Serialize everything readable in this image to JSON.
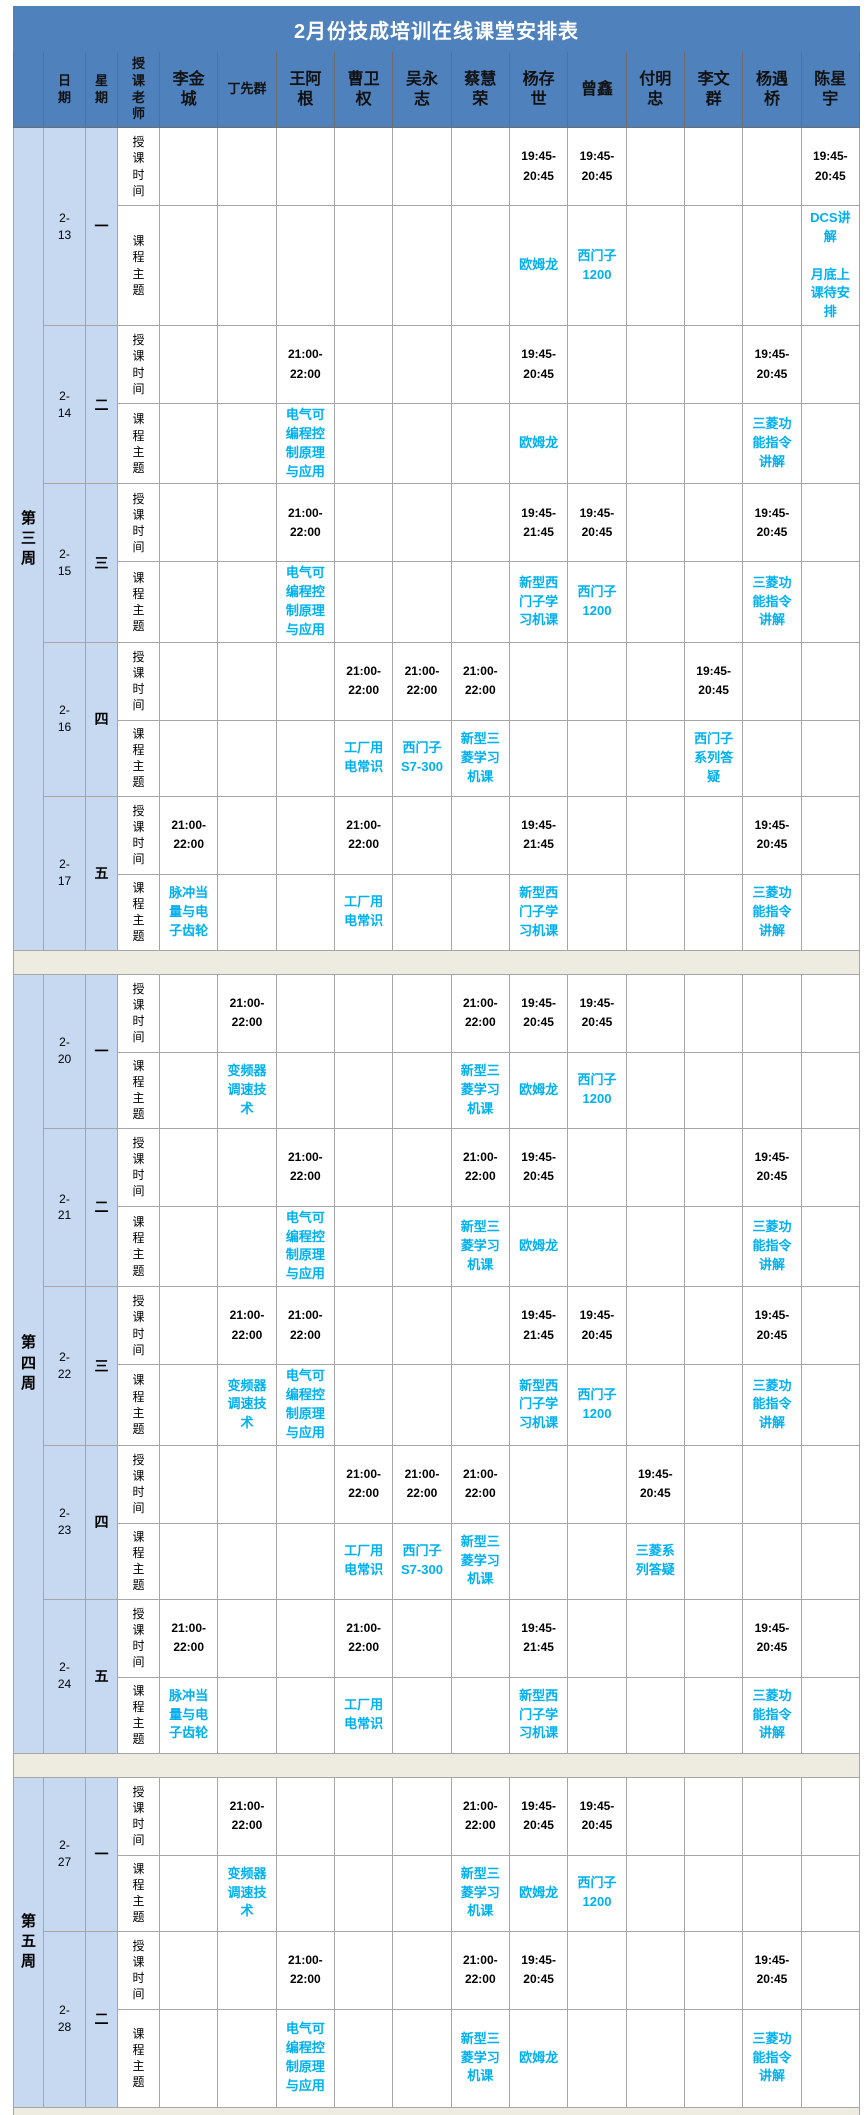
{
  "title": "2月份技成培训在线课堂安排表",
  "header": {
    "date": "日期",
    "weekday": "星期",
    "teacher_label": "授课老师",
    "teachers": [
      "李金城",
      "丁先群",
      "王阿根",
      "曹卫权",
      "吴永志",
      "蔡慧荣",
      "杨存世",
      "曾鑫",
      "付明忠",
      "李文群",
      "杨遇桥",
      "陈星宇"
    ]
  },
  "row_labels": {
    "time": "授课时间",
    "topic": "课程主题"
  },
  "colors": {
    "header_blue": "#4F81BD",
    "light_blue": "#C6D9F1",
    "topic_text": "#00B0F0",
    "separator_beige": "#EEECE1",
    "border_gray": "#A6A6A6",
    "title_text": "#FFFFFF"
  },
  "weeks": [
    {
      "label": "第三周",
      "days": [
        {
          "date": "2-13",
          "weekday": "一",
          "times": [
            "",
            "",
            "",
            "",
            "",
            "",
            "19:45-20:45",
            "19:45-20:45",
            "",
            "",
            "",
            "19:45-20:45"
          ],
          "topics": [
            "",
            "",
            "",
            "",
            "",
            "",
            "欧姆龙",
            "西门子1200",
            "",
            "",
            "",
            "DCS讲解\n\n月底上课待安排"
          ]
        },
        {
          "date": "2-14",
          "weekday": "二",
          "times": [
            "",
            "",
            "21:00-22:00",
            "",
            "",
            "",
            "19:45-20:45",
            "",
            "",
            "",
            "19:45-20:45",
            ""
          ],
          "topics": [
            "",
            "",
            "电气可编程控制原理与应用",
            "",
            "",
            "",
            "欧姆龙",
            "",
            "",
            "",
            "三菱功能指令讲解",
            ""
          ]
        },
        {
          "date": "2-15",
          "weekday": "三",
          "times": [
            "",
            "",
            "21:00-22:00",
            "",
            "",
            "",
            "19:45-21:45",
            "19:45-20:45",
            "",
            "",
            "19:45-20:45",
            ""
          ],
          "topics": [
            "",
            "",
            "电气可编程控制原理与应用",
            "",
            "",
            "",
            "新型西门子学习机课",
            "西门子1200",
            "",
            "",
            "三菱功能指令讲解",
            ""
          ]
        },
        {
          "date": "2-16",
          "weekday": "四",
          "times": [
            "",
            "",
            "",
            "21:00-22:00",
            "21:00-22:00",
            "21:00-22:00",
            "",
            "",
            "",
            "19:45-20:45",
            "",
            ""
          ],
          "topics": [
            "",
            "",
            "",
            "工厂用电常识",
            "西门子S7-300",
            "新型三菱学习机课",
            "",
            "",
            "",
            "西门子系列答疑",
            "",
            ""
          ]
        },
        {
          "date": "2-17",
          "weekday": "五",
          "times": [
            "21:00-22:00",
            "",
            "",
            "21:00-22:00",
            "",
            "",
            "19:45-21:45",
            "",
            "",
            "",
            "19:45-20:45",
            ""
          ],
          "topics": [
            "脉冲当量与电子齿轮",
            "",
            "",
            "工厂用电常识",
            "",
            "",
            "新型西门子学习机课",
            "",
            "",
            "",
            "三菱功能指令讲解",
            ""
          ]
        }
      ]
    },
    {
      "label": "第四周",
      "days": [
        {
          "date": "2-20",
          "weekday": "一",
          "times": [
            "",
            "21:00-22:00",
            "",
            "",
            "",
            "21:00-22:00",
            "19:45-20:45",
            "19:45-20:45",
            "",
            "",
            "",
            ""
          ],
          "topics": [
            "",
            "变频器调速技术",
            "",
            "",
            "",
            "新型三菱学习机课",
            "欧姆龙",
            "西门子1200",
            "",
            "",
            "",
            ""
          ]
        },
        {
          "date": "2-21",
          "weekday": "二",
          "times": [
            "",
            "",
            "21:00-22:00",
            "",
            "",
            "21:00-22:00",
            "19:45-20:45",
            "",
            "",
            "",
            "19:45-20:45",
            ""
          ],
          "topics": [
            "",
            "",
            "电气可编程控制原理与应用",
            "",
            "",
            "新型三菱学习机课",
            "欧姆龙",
            "",
            "",
            "",
            "三菱功能指令讲解",
            ""
          ]
        },
        {
          "date": "2-22",
          "weekday": "三",
          "times": [
            "",
            "21:00-22:00",
            "21:00-22:00",
            "",
            "",
            "",
            "19:45-21:45",
            "19:45-20:45",
            "",
            "",
            "19:45-20:45",
            ""
          ],
          "topics": [
            "",
            "变频器调速技术",
            "电气可编程控制原理与应用",
            "",
            "",
            "",
            "新型西门子学习机课",
            "西门子1200",
            "",
            "",
            "三菱功能指令讲解",
            ""
          ]
        },
        {
          "date": "2-23",
          "weekday": "四",
          "times": [
            "",
            "",
            "",
            "21:00-22:00",
            "21:00-22:00",
            "21:00-22:00",
            "",
            "",
            "19:45-20:45",
            "",
            "",
            ""
          ],
          "topics": [
            "",
            "",
            "",
            "工厂用电常识",
            "西门子S7-300",
            "新型三菱学习机课",
            "",
            "",
            "三菱系列答疑",
            "",
            "",
            ""
          ]
        },
        {
          "date": "2-24",
          "weekday": "五",
          "times": [
            "21:00-22:00",
            "",
            "",
            "21:00-22:00",
            "",
            "",
            "19:45-21:45",
            "",
            "",
            "",
            "19:45-20:45",
            ""
          ],
          "topics": [
            "脉冲当量与电子齿轮",
            "",
            "",
            "工厂用电常识",
            "",
            "",
            "新型西门子学习机课",
            "",
            "",
            "",
            "三菱功能指令讲解",
            ""
          ]
        }
      ]
    },
    {
      "label": "第五周",
      "days": [
        {
          "date": "2-27",
          "weekday": "一",
          "times": [
            "",
            "21:00-22:00",
            "",
            "",
            "",
            "21:00-22:00",
            "19:45-20:45",
            "19:45-20:45",
            "",
            "",
            "",
            ""
          ],
          "topics": [
            "",
            "变频器调速技术",
            "",
            "",
            "",
            "新型三菱学习机课",
            "欧姆龙",
            "西门子1200",
            "",
            "",
            "",
            ""
          ]
        },
        {
          "date": "2-28",
          "weekday": "二",
          "times": [
            "",
            "",
            "21:00-22:00",
            "",
            "",
            "21:00-22:00",
            "19:45-20:45",
            "",
            "",
            "",
            "19:45-20:45",
            ""
          ],
          "topics": [
            "",
            "",
            "电气可编程控制原理与应用",
            "",
            "",
            "新型三菱学习机课",
            "欧姆龙",
            "",
            "",
            "",
            "三菱功能指令讲解",
            ""
          ]
        }
      ]
    }
  ]
}
